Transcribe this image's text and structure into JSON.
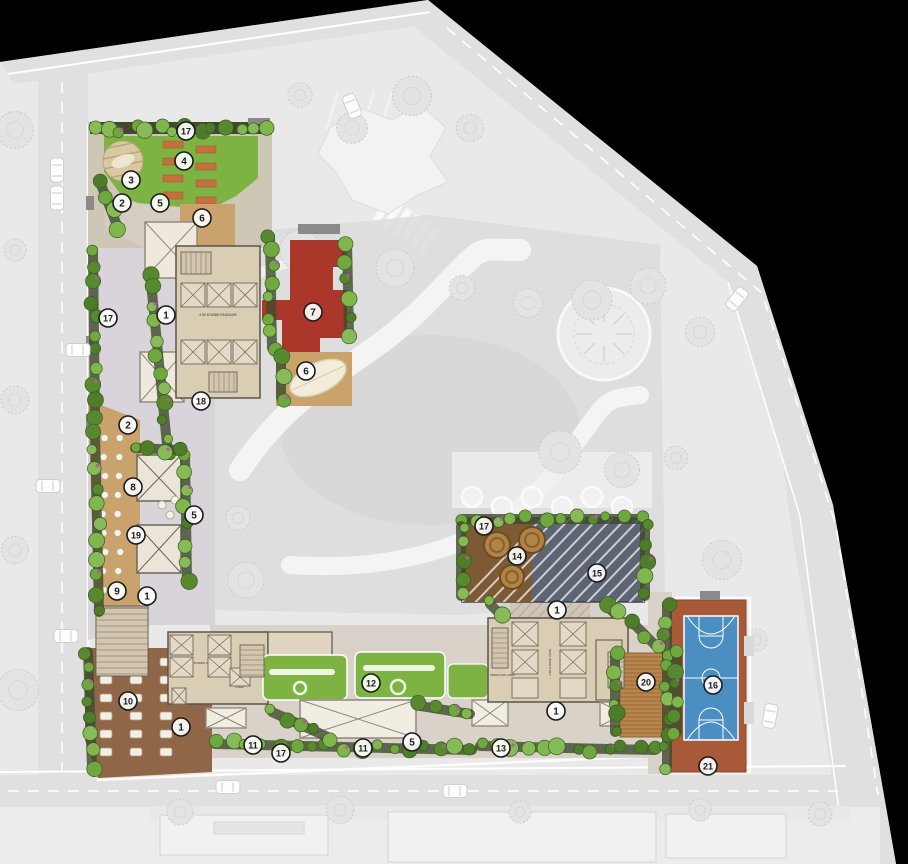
{
  "plan": {
    "markers": [
      {
        "n": "17",
        "x": 186,
        "y": 131
      },
      {
        "n": "4",
        "x": 184,
        "y": 161
      },
      {
        "n": "3",
        "x": 131,
        "y": 180
      },
      {
        "n": "2",
        "x": 122,
        "y": 203
      },
      {
        "n": "5",
        "x": 160,
        "y": 203
      },
      {
        "n": "6",
        "x": 202,
        "y": 218
      },
      {
        "n": "1",
        "x": 166,
        "y": 315
      },
      {
        "n": "7",
        "x": 313,
        "y": 312
      },
      {
        "n": "17",
        "x": 108,
        "y": 318
      },
      {
        "n": "6",
        "x": 306,
        "y": 371
      },
      {
        "n": "18",
        "x": 201,
        "y": 401
      },
      {
        "n": "2",
        "x": 128,
        "y": 425
      },
      {
        "n": "8",
        "x": 133,
        "y": 487
      },
      {
        "n": "5",
        "x": 194,
        "y": 515
      },
      {
        "n": "19",
        "x": 136,
        "y": 535
      },
      {
        "n": "9",
        "x": 117,
        "y": 591
      },
      {
        "n": "1",
        "x": 147,
        "y": 596
      },
      {
        "n": "10",
        "x": 128,
        "y": 701
      },
      {
        "n": "1",
        "x": 181,
        "y": 727
      },
      {
        "n": "11",
        "x": 253,
        "y": 745
      },
      {
        "n": "17",
        "x": 281,
        "y": 753
      },
      {
        "n": "11",
        "x": 363,
        "y": 748
      },
      {
        "n": "12",
        "x": 371,
        "y": 683
      },
      {
        "n": "5",
        "x": 412,
        "y": 742
      },
      {
        "n": "13",
        "x": 501,
        "y": 748
      },
      {
        "n": "17",
        "x": 484,
        "y": 526
      },
      {
        "n": "14",
        "x": 517,
        "y": 556
      },
      {
        "n": "15",
        "x": 597,
        "y": 573
      },
      {
        "n": "1",
        "x": 557,
        "y": 610
      },
      {
        "n": "1",
        "x": 556,
        "y": 711
      },
      {
        "n": "20",
        "x": 646,
        "y": 682
      },
      {
        "n": "16",
        "x": 713,
        "y": 685
      },
      {
        "n": "21",
        "x": 708,
        "y": 766
      }
    ],
    "labels": {
      "passage_top": "2.50 M WIDE PASSAGE",
      "passage_sw": "1.50 M WIDE PASS.",
      "passage_s": "1.85 M WIDE PASS.",
      "lift": "LIFT",
      "lift_shaft": "LIFT SHAFT",
      "lobby_s": "SMOKE CHK LOBBY",
      "lobby_sw": "LOBBY"
    },
    "colors": {
      "background": "#000000",
      "site": "#e9e9e9",
      "road": "#e0e0e0",
      "garden_faded": "#dcdcdc",
      "lawn": "#7cb342",
      "red_zone": "#ab372b",
      "court_blue": "#4b8ec2",
      "court_surround": "#a85a38",
      "building": "#d9cdb4",
      "wall": "#5a544c",
      "deck_wood": "#c9a36b",
      "deck_dark": "#5d6472",
      "deck_brown": "#8f6647",
      "planting": "#3f4a2e",
      "tree_green": "#6fa83f",
      "path": "#d8d4da",
      "marker_stroke": "#1a1a1a"
    }
  }
}
